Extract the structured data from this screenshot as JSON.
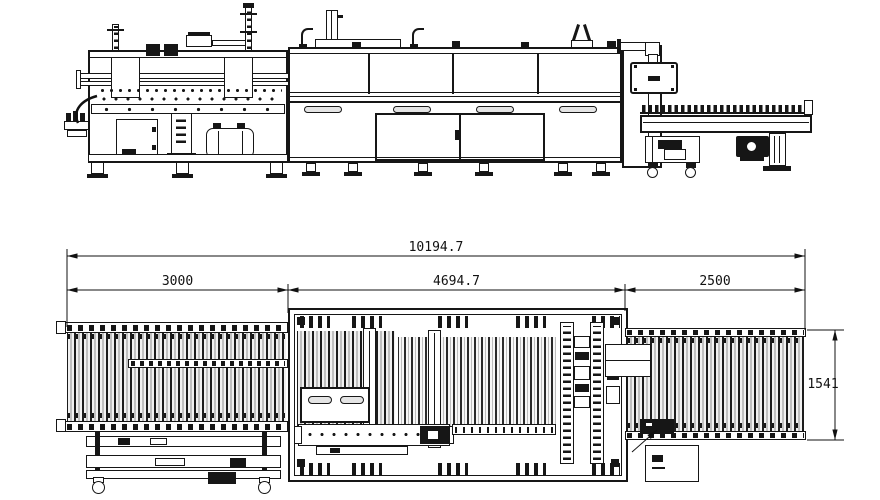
{
  "drawing": {
    "background_color": "#ffffff",
    "line_color": "#161616",
    "dimensions": {
      "overall_length": "10194.7",
      "segment_left": "3000",
      "segment_middle": "4694.7",
      "segment_right": "2500",
      "depth": "1541"
    }
  }
}
